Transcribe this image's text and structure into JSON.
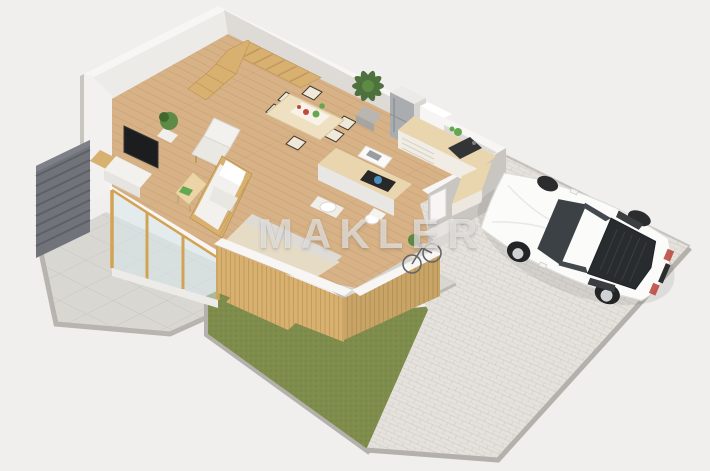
{
  "watermark": {
    "text": "MAKLER"
  },
  "scene": {
    "type": "3d-isometric-floor-plan-render",
    "areas": [
      "living-room",
      "dining-area",
      "kitchen",
      "bathroom",
      "entry",
      "terrace",
      "lawn",
      "paved-driveway"
    ],
    "objects": [
      {
        "id": "staircase",
        "label": "wooden winder staircase"
      },
      {
        "id": "tv-unit",
        "label": "flat tv with white media stand"
      },
      {
        "id": "lounge-chair",
        "label": "white lounge chair"
      },
      {
        "id": "sofa",
        "label": "white sofa with wooden frame"
      },
      {
        "id": "coffee-table",
        "label": "wooden coffee table with green magazine"
      },
      {
        "id": "dining-set",
        "label": "dining table with six chairs"
      },
      {
        "id": "palm-plant",
        "label": "large potted palm"
      },
      {
        "id": "small-plant",
        "label": "small potted plant"
      },
      {
        "id": "fridge",
        "label": "tall stainless fridge unit"
      },
      {
        "id": "kitchen-counter",
        "label": "l-shaped kitchen counter with sink"
      },
      {
        "id": "kitchen-island",
        "label": "island with dark cooktop and blue kettle"
      },
      {
        "id": "laptop-desk",
        "label": "small white desk with laptop"
      },
      {
        "id": "bathroom-fixtures",
        "label": "round basin and toilet"
      },
      {
        "id": "glass-doors",
        "label": "floor-to-ceiling sliding glass doors with golden frames"
      },
      {
        "id": "facade-pod",
        "label": "wood-slat clad bathroom/entry volume"
      },
      {
        "id": "privacy-fence",
        "label": "dark grey louvered fence"
      },
      {
        "id": "bicycle",
        "label": "bicycle at entry"
      },
      {
        "id": "sports-car",
        "label": "white sports coupe parked on driveway"
      }
    ],
    "dining_chairs_count": 6
  },
  "colors": {
    "bg": "#f1efee",
    "watermark": "rgba(255,255,255,0.58)",
    "wall-top": "#f7f6f4",
    "wall-light": "#edebe8",
    "wall-mid": "#dedbd6",
    "wall-dark": "#c9c6c1",
    "floor-wood": "#d7b286",
    "floor-line": "#c49a6e",
    "terrace": "#d9d7d2",
    "terrace-line": "#c6c4bf",
    "grass": "#7e8c4c",
    "paver": "#e5e1dc",
    "curb": "#b4b1ac",
    "fence": "#70747a",
    "fence-line": "#5d6167",
    "wood-slat": "#d8b170",
    "wood-slat-dark": "#bb9254",
    "wood-frame": "#d2a355",
    "glass": "#d8e8ec",
    "counter-wood": "#e9d6ae",
    "steel": "#a9adb0",
    "white-furn": "#f3f1ee",
    "dark-item": "#28282a",
    "plant-green": "#5d8a44",
    "plant-dark": "#41682f",
    "accent-red": "#c0493f",
    "accent-green": "#63a84f",
    "accent-blue": "#4a8fbf",
    "car-white": "#fbfbfa",
    "car-glass": "#3c4145"
  }
}
